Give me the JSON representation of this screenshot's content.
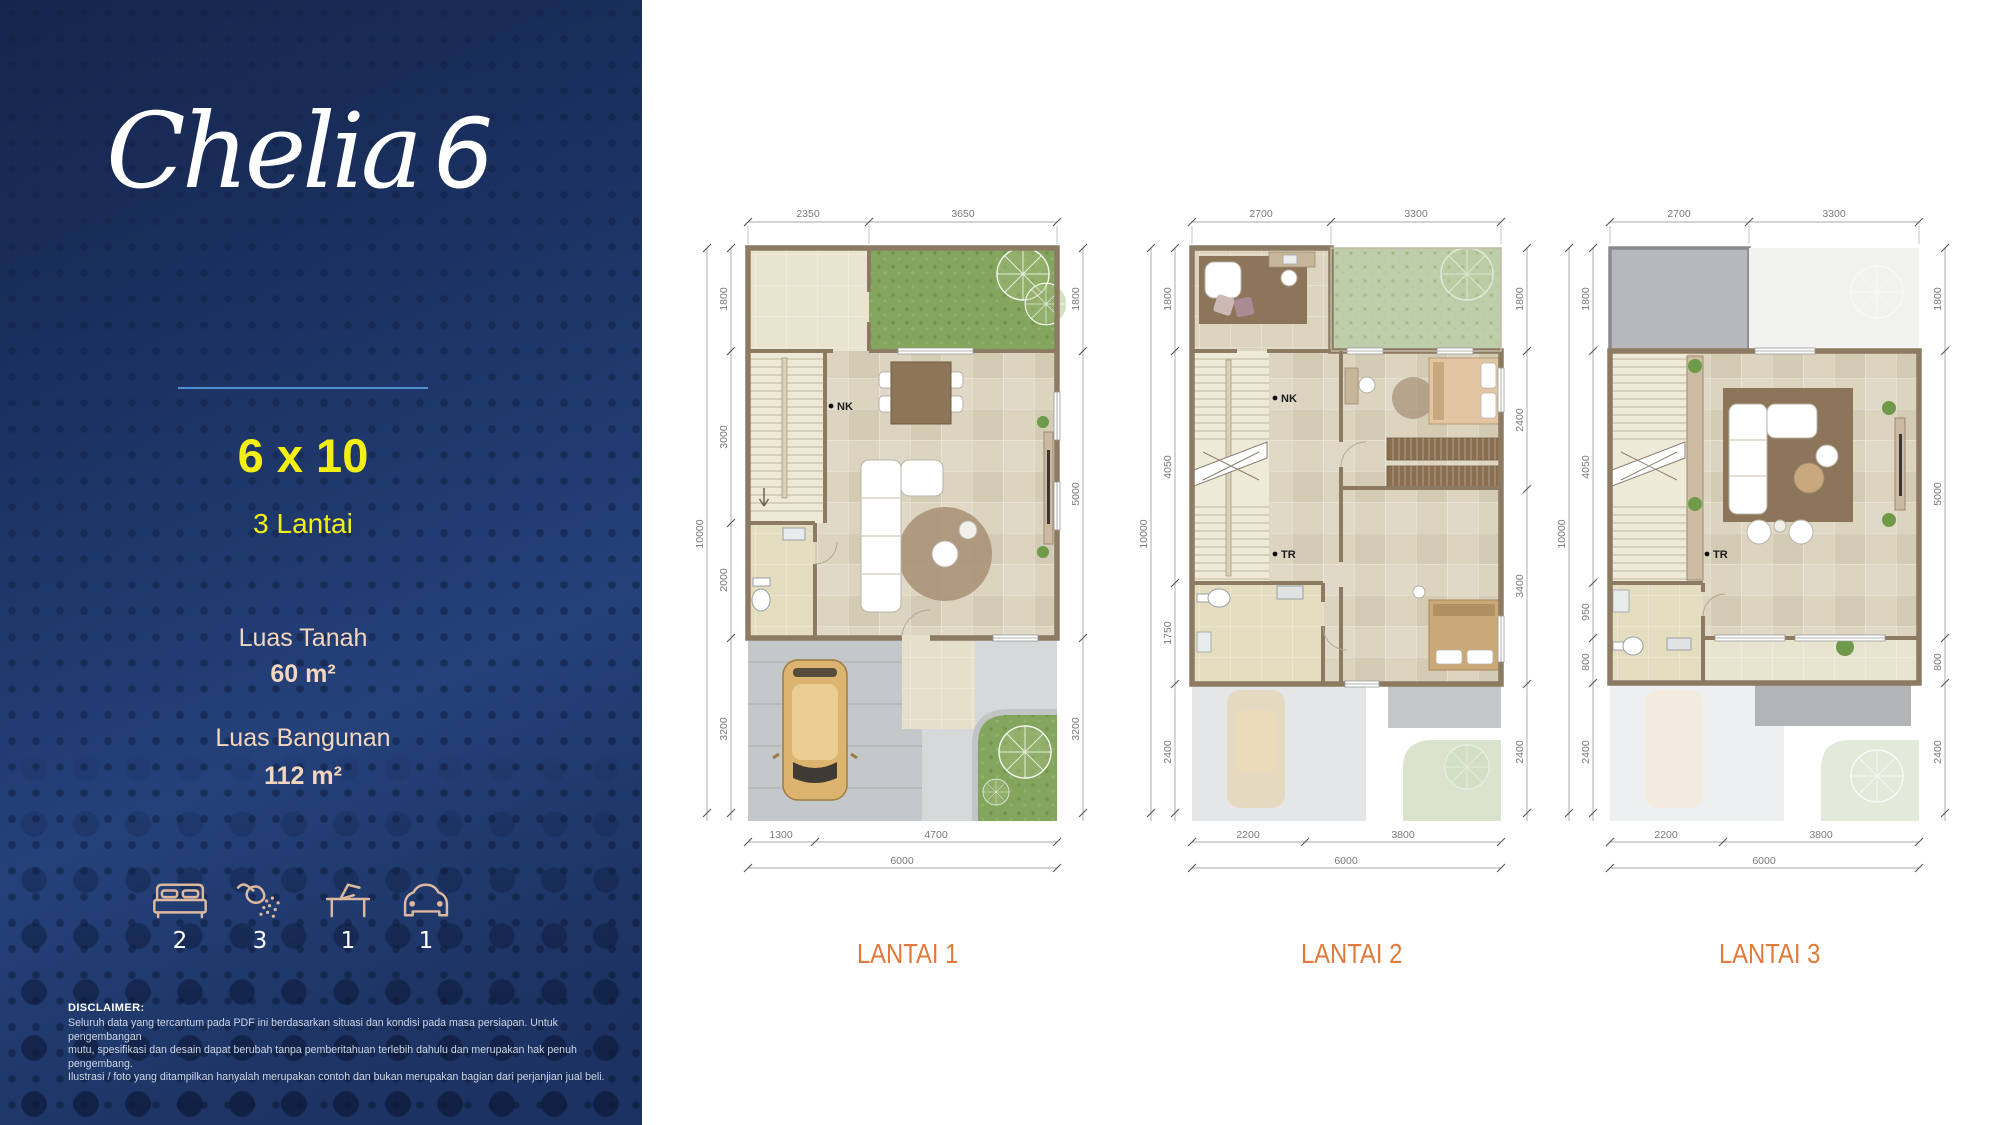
{
  "sidebar": {
    "title_script": "Chelia",
    "title_number": "6",
    "size": "6 x 10",
    "floors": "3 Lantai",
    "land_label": "Luas Tanah",
    "land_value": "60 m²",
    "building_label": "Luas Bangunan",
    "building_value": "112 m²",
    "features": [
      {
        "icon": "bed-icon",
        "count": "2"
      },
      {
        "icon": "shower-icon",
        "count": "3"
      },
      {
        "icon": "desk-icon",
        "count": "1"
      },
      {
        "icon": "car-icon",
        "count": "1"
      }
    ],
    "disclaimer_title": "DISCLAIMER:",
    "disclaimer_lines": [
      "Seluruh data yang tercantum pada PDF ini berdasarkan situasi dan kondisi pada masa persiapan. Untuk pengembangan",
      "mutu, spesifikasi dan desain dapat berubah tanpa pemberitahuan terlebih dahulu dan merupakan hak penuh pengembang.",
      "Ilustrasi / foto yang ditampilkan hanyalah merupakan contoh dan bukan merupakan bagian dari perjanjian jual beli."
    ]
  },
  "plans": [
    {
      "caption": "LANTAI 1",
      "markers": {
        "nk": "NK"
      },
      "dims": {
        "top": [
          "2350",
          "3650"
        ],
        "left_total": "10000",
        "left": [
          "1800",
          "3000",
          "2000",
          "3200"
        ],
        "right": [
          "1800",
          "5000",
          "3200"
        ],
        "bottom": [
          "1300",
          "4700"
        ],
        "bottom_total": "6000"
      }
    },
    {
      "caption": "LANTAI 2",
      "markers": {
        "nk": "NK",
        "tr": "TR"
      },
      "dims": {
        "top": [
          "2700",
          "3300"
        ],
        "left_total": "10000",
        "left": [
          "1800",
          "4050",
          "1750",
          "2400"
        ],
        "right": [
          "1800",
          "2400",
          "3400",
          "2400"
        ],
        "bottom": [
          "2200",
          "3800"
        ],
        "bottom_total": "6000"
      }
    },
    {
      "caption": "LANTAI 3",
      "markers": {
        "tr": "TR"
      },
      "dims": {
        "top": [
          "2700",
          "3300"
        ],
        "left_total": "10000",
        "left": [
          "1800",
          "4050",
          "950",
          "800",
          "2400"
        ],
        "right": [
          "1800",
          "5000",
          "800",
          "2400"
        ],
        "bottom": [
          "2200",
          "3800"
        ],
        "bottom_total": "6000"
      }
    }
  ],
  "colors": {
    "navy": "#1b3161",
    "accent_yellow": "#f3ef12",
    "accent_peach": "#f4d6be",
    "caption_orange": "#e0793a",
    "divider_blue": "#4e8fd0",
    "wall_brown": "#8c7a63"
  }
}
